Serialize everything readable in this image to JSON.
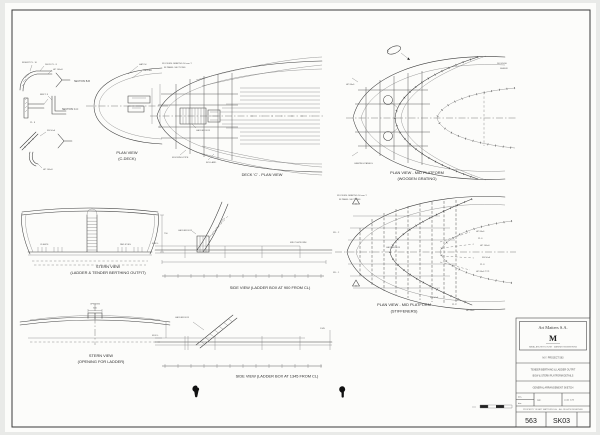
{
  "drawing": {
    "captions": {
      "section_bb": "SECTION B-B",
      "section_cc": "SECTION C-C",
      "plan_c_deck_l1": "PLAN VIEW",
      "plan_c_deck_l2": "(C-DECK)",
      "deck_c_plan": "DECK 'C' - PLAN VIEW",
      "plan_mid_grating_l1": "PLAN VIEW - MID PLATFORM",
      "plan_mid_grating_l2": "(WOODEN GRATING)",
      "stern_berthing_l1": "STERN VIEW",
      "stern_berthing_l2": "(LADDER & TENDER BERTHING OUTFIT)",
      "side_view_900": "SIDE VIEW (LADDER BOX AT 900 FROM CL)",
      "plan_mid_stiffeners_l1": "PLAN VIEW - MID PLATFORM",
      "plan_mid_stiffeners_l2": "(STIFFENERS)",
      "stern_opening_l1": "STERN VIEW",
      "stern_opening_l2": "(OPENING FOR LADDER)",
      "side_view_1345": "SIDE VIEW (LADDER BOX AT 1345 FROM CL)"
    },
    "notes": {
      "grating_note_l1": "WOODEN GRATING 50 mm T.",
      "grating_note_l2": "IN PANEL SECTIONS",
      "stiff_note_l1": "WOODEN GRATING 50 mm T.",
      "stiff_note_l2": "IN PANEL SECTIONS"
    },
    "micro": {
      "s1": "DECK PL. 8",
      "s2": "HP 100x8",
      "s3": "BRKT. 8",
      "s4": "FB 50x6",
      "s5": "INSERT PL. 10",
      "s6": "PL. 8",
      "p1": "HATCH",
      "p2": "LADDER",
      "c1": "MOORING PIPE",
      "c2": "BOLLARD",
      "c3": "LADDER BOX",
      "d1": "DK EDGE",
      "d2": "SHEER",
      "d3": "HP 80x6",
      "d4": "GRATING PANELS",
      "d5": "C",
      "e1": "CLEATS",
      "e2": "PAD EYES",
      "e3": "750",
      "f1": "LADDER BOX",
      "f2": "MID PLATFORM",
      "f3": "M.W.L.",
      "g1": "HP 80x6",
      "g2": "PL 6",
      "g3": "HP 100x6",
      "g4": "FB 50x6",
      "g5": "PL 8",
      "g6": "HP 80x6 TYP.",
      "g7": "W.L. 2",
      "g8": "W.L. 1",
      "g9": "A",
      "h1": "600",
      "h2": "OPENING",
      "i1": "LADDER BOX",
      "i2": "M.W.L.",
      "i3": "1345"
    },
    "title_block": {
      "company": "Art Matters S.A.",
      "logo": "M",
      "tagline": "NAVAL ARCHITECTURE · MARINE ENGINEERING",
      "row1": "M.Y. PROJECT 563",
      "row2_l1": "TENDER BERTHING & LADDER OUTFIT",
      "row2_l2": "BOW & STERN PLATFORM DETAILS",
      "row3": "GENERAL ARRANGEMENT SKETCH",
      "f_des": "des.",
      "f_drn": "drn.",
      "f_app": "app.",
      "f_scale": "scale 1:25",
      "note": "PROPERTY OF ART MATTERS S.A. · ALL RIGHTS RESERVED",
      "project_no": "563",
      "sheet_no": "SK03"
    }
  }
}
